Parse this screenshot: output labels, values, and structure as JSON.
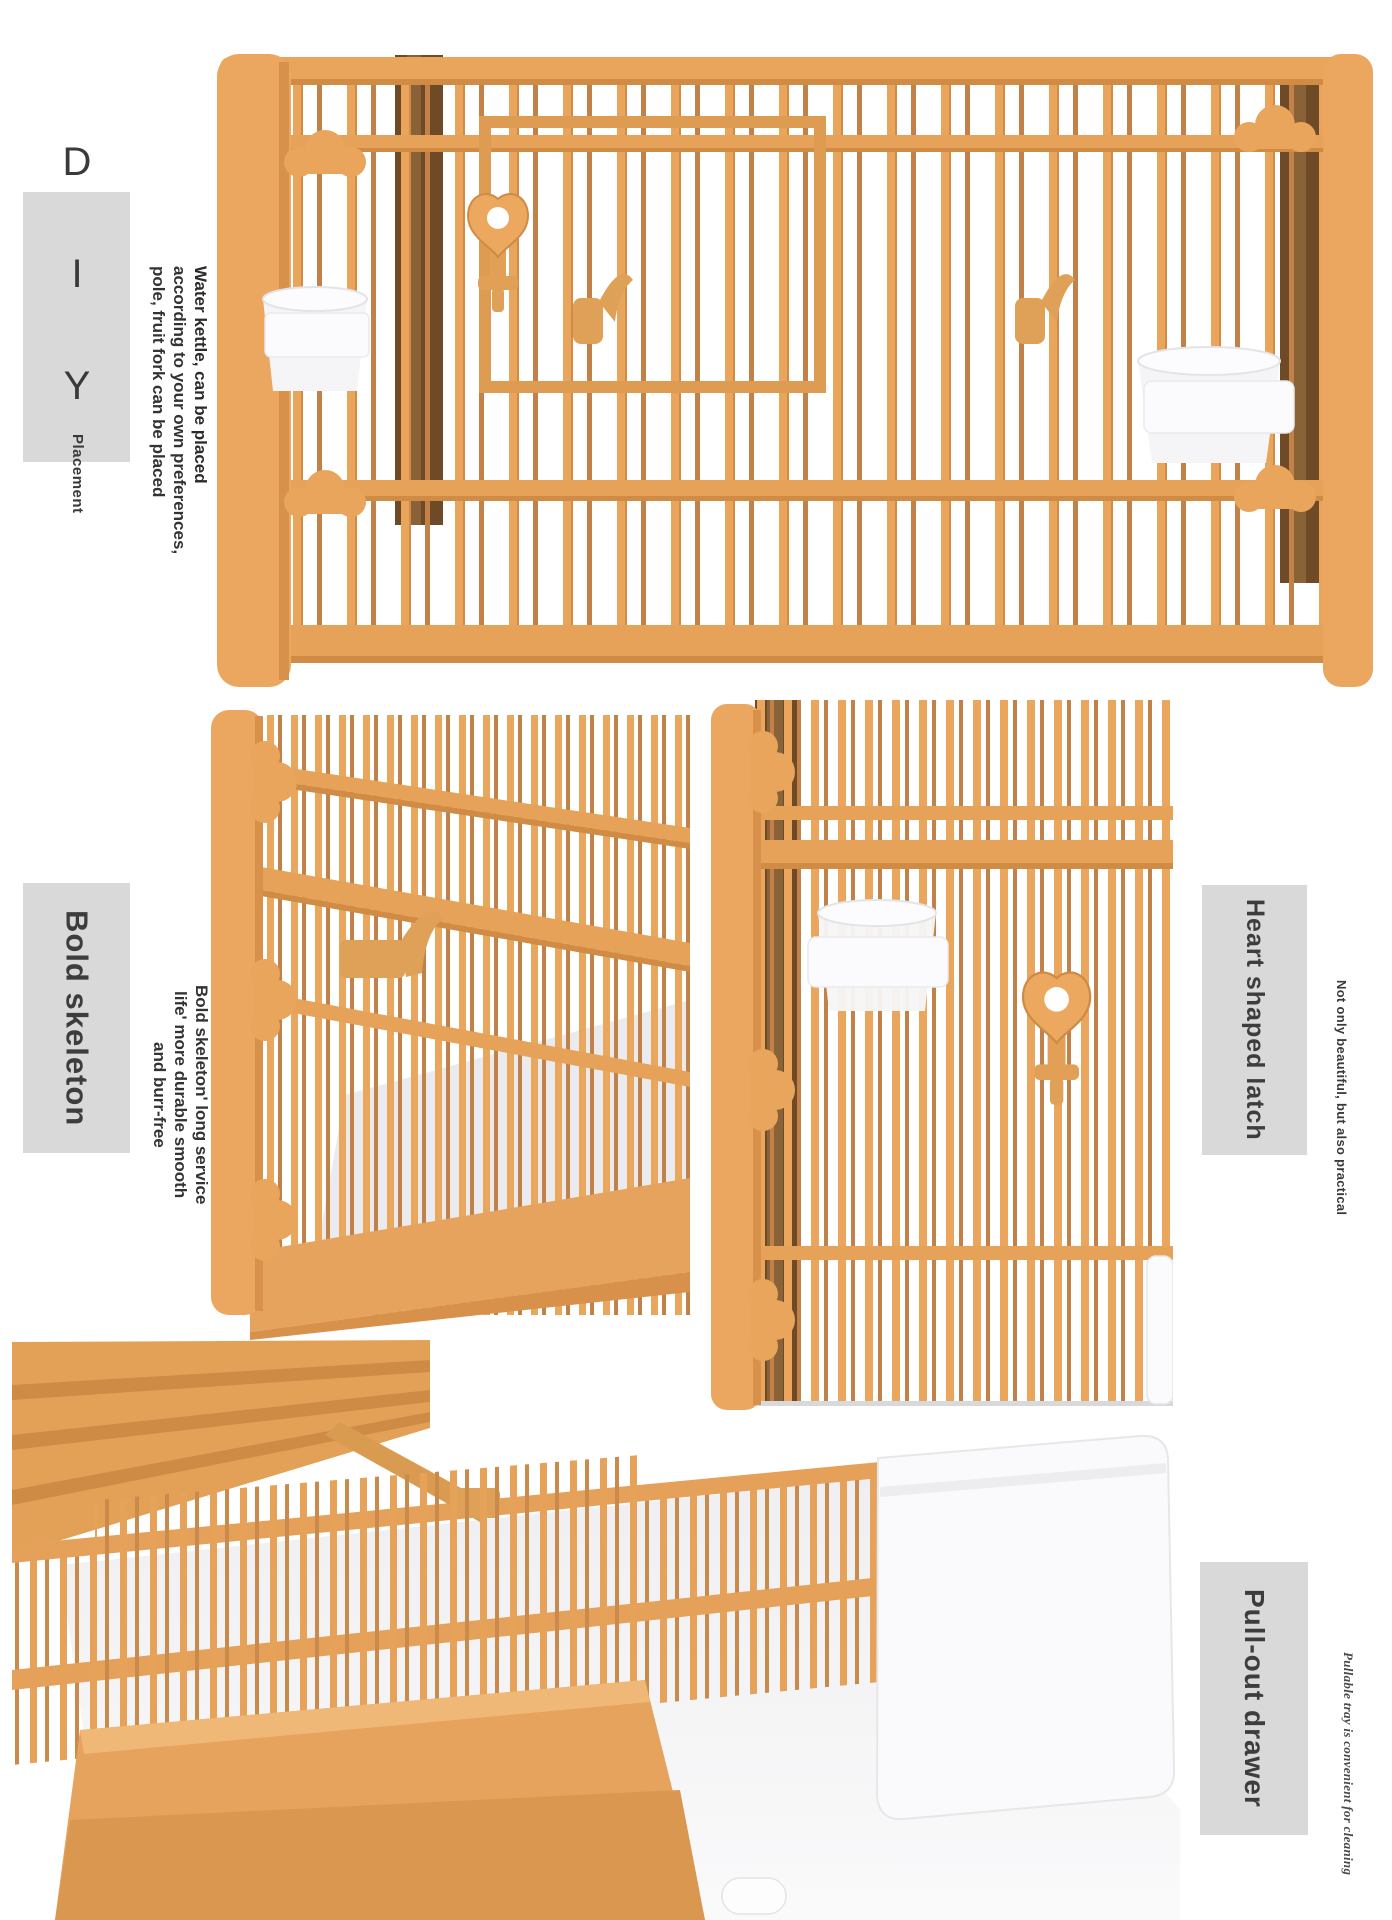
{
  "page": {
    "background": "#ffffff"
  },
  "colors": {
    "cage_tan": "#E9A55C",
    "cage_tan_light": "#F0B877",
    "cage_tan_dark": "#CE8B46",
    "cage_brown_dark": "#6E4A27",
    "label_box_bg": "#D9D9D9",
    "label_text": "#3D3D3D",
    "body_text": "#333333",
    "floor_gray": "#EBEBED",
    "tray_white": "#FAFAFC"
  },
  "sections": {
    "diy": {
      "heading": "D I Y",
      "subheading": "Placement",
      "lines": [
        "Water kettle, can be placed",
        "according to your own preferences,",
        "pole, fruit fork can be placed"
      ]
    },
    "skeleton": {
      "label": "Bold skeleton",
      "lines": [
        "Bold skeleton' long service",
        "life' more durable smooth",
        "and burr-free"
      ]
    },
    "latch": {
      "label": "Heart shaped latch",
      "note": "Not only beautiful, but also practical"
    },
    "drawer": {
      "label": "Pull-out drawer",
      "note": "Pullable tray is convenient for cleaning"
    }
  }
}
